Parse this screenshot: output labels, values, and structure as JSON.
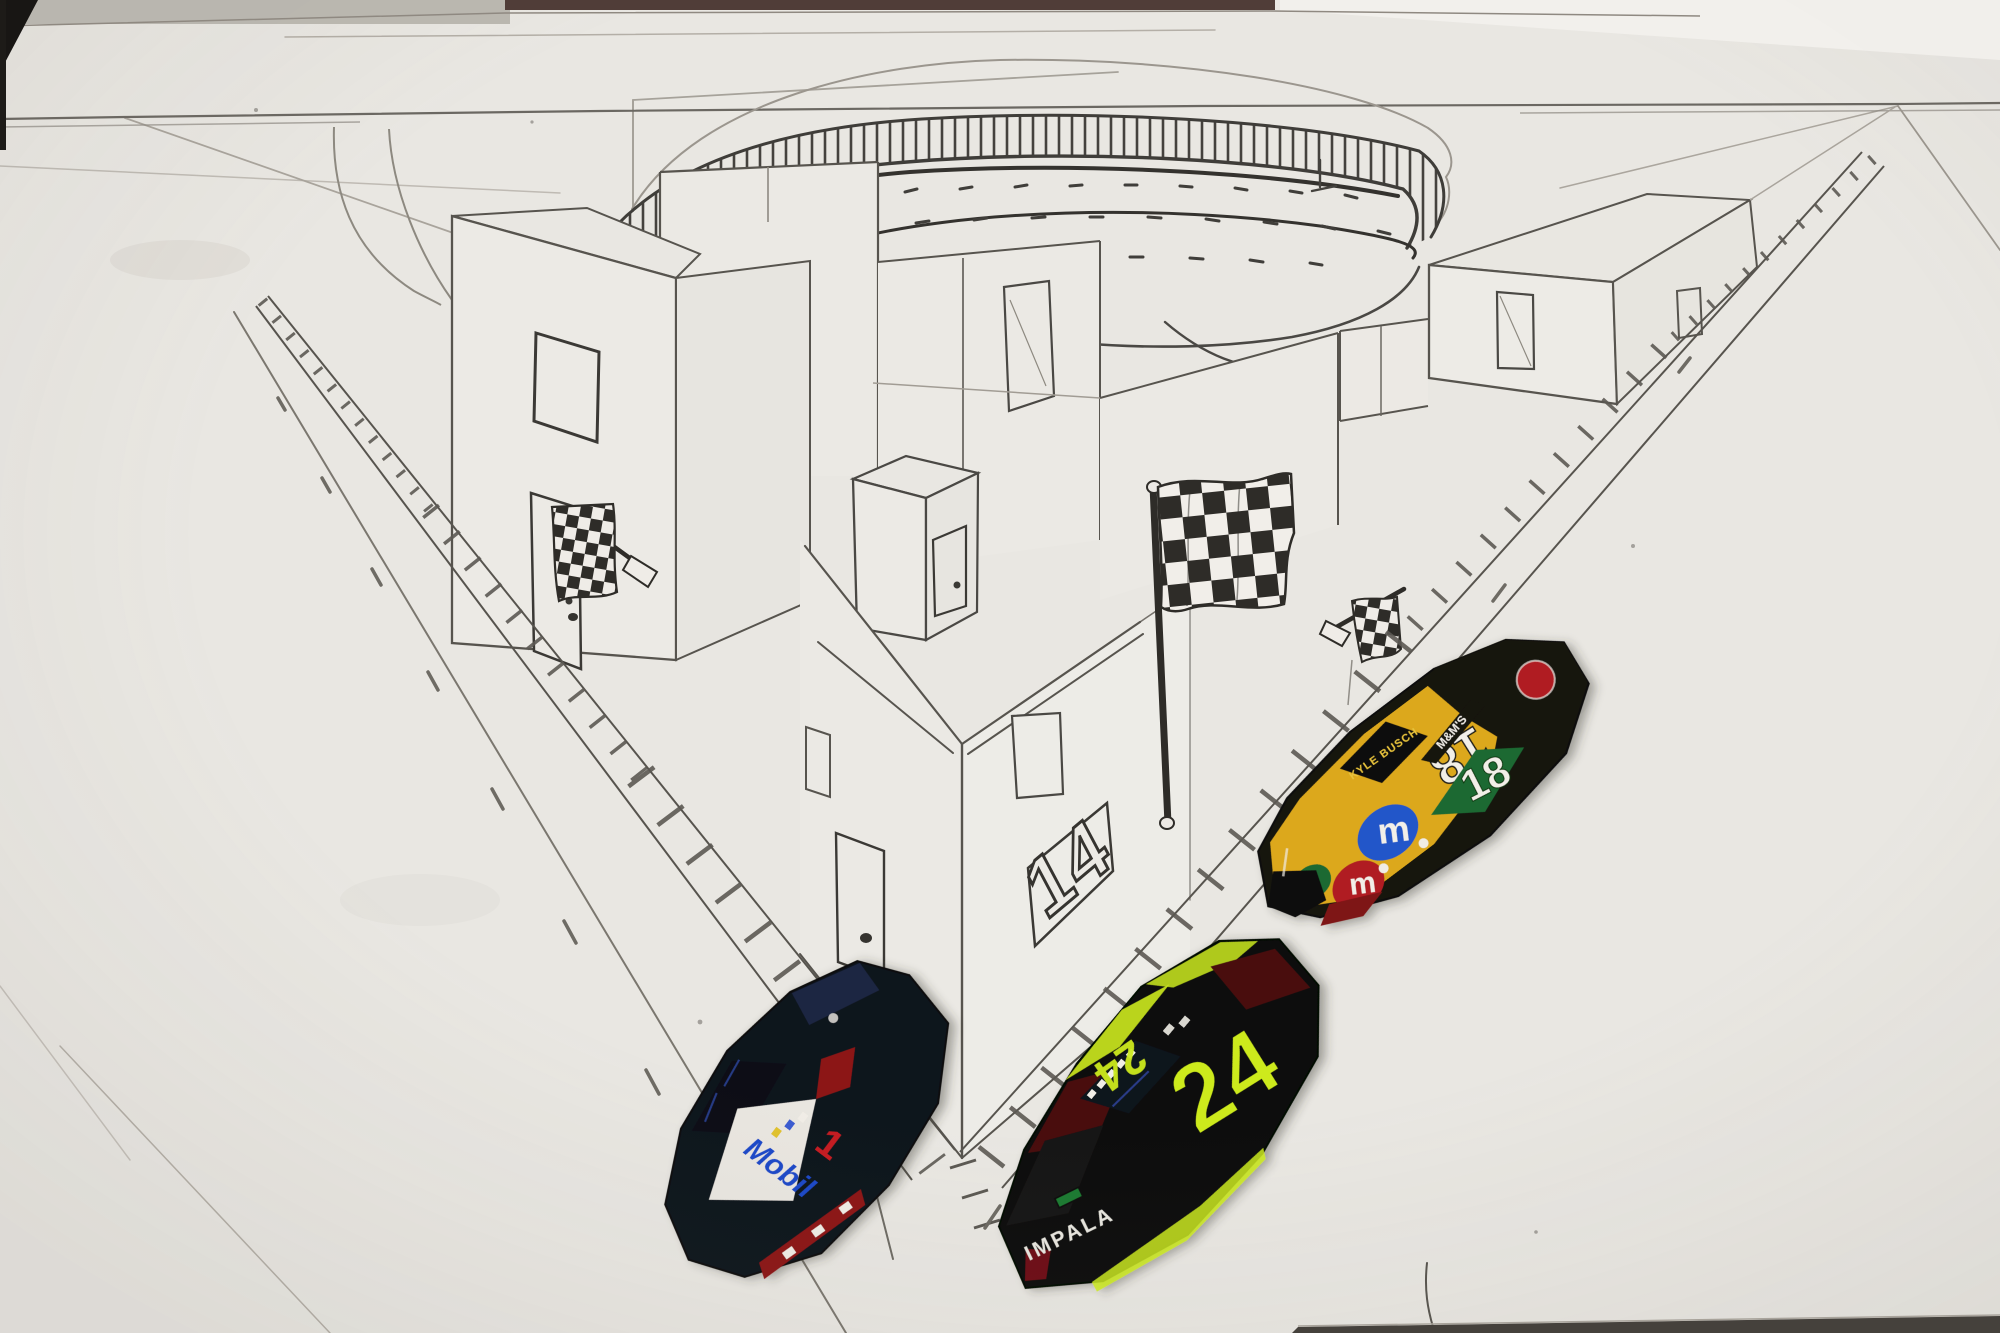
{
  "scene": {
    "sign_number": "14"
  },
  "cars": {
    "mobil_car": {
      "hood_brand": "Mobil",
      "hood_number": "1"
    },
    "car_24": {
      "roof_number": "24",
      "door_number": "24",
      "bumper_text": "IMPALA"
    },
    "car_18": {
      "roof_number": "18",
      "door_number": "18",
      "windshield_text": "KYLE BUSCH",
      "door_panel_text": "M&M'S",
      "mm_logo_letter": "m"
    }
  },
  "palette": {
    "paper": "#e9e7e2",
    "pencil": "#57544e",
    "pencil_dark": "#2e2c28",
    "checker_dark": "#2e2c28",
    "mm_yellow": "#dca81e",
    "mm_green": "#1b6930",
    "mm_red": "#b01b22",
    "mm_blue": "#2057c9",
    "neon_green": "#cdea1f",
    "maroon": "#4a0d11",
    "car24_black": "#0d0f0c",
    "mobil_navy": "#10131f",
    "mobil_blue": "#1e49c8",
    "mobil_red": "#c41e22",
    "white": "#f2efe8"
  }
}
